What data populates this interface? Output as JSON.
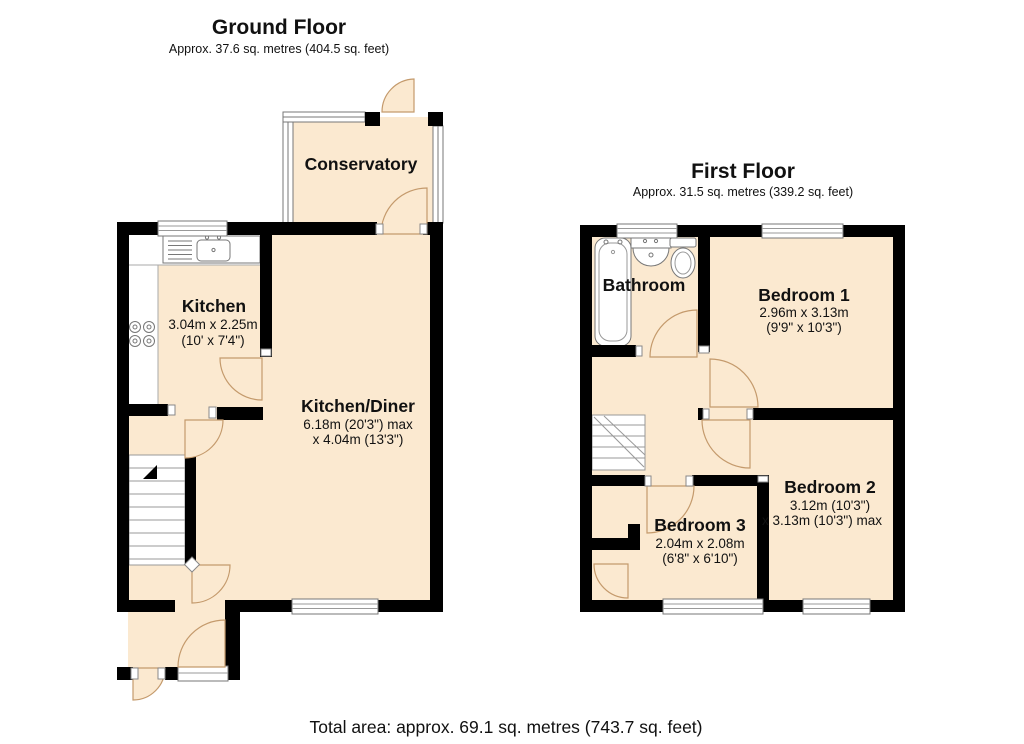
{
  "colors": {
    "room_fill": "#FBE9D0",
    "wall": "#000000",
    "door_arc_stroke": "#C49A6C",
    "fixture_stroke": "#777777"
  },
  "ground_floor": {
    "title": "Ground Floor",
    "subtitle": "Approx. 37.6 sq. metres (404.5 sq. feet)",
    "rooms": {
      "conservatory": {
        "name": "Conservatory"
      },
      "kitchen": {
        "name": "Kitchen",
        "dims_metric": "3.04m x 2.25m",
        "dims_imperial": "(10' x 7'4\")"
      },
      "kitchen_diner": {
        "name": "Kitchen/Diner",
        "dims_line1": "6.18m (20'3\") max",
        "dims_line2": "x 4.04m (13'3\")"
      }
    }
  },
  "first_floor": {
    "title": "First Floor",
    "subtitle": "Approx. 31.5 sq. metres (339.2 sq. feet)",
    "rooms": {
      "bathroom": {
        "name": "Bathroom"
      },
      "bedroom_1": {
        "name": "Bedroom 1",
        "dims_metric": "2.96m x 3.13m",
        "dims_imperial": "(9'9\" x 10'3\")"
      },
      "bedroom_2": {
        "name": "Bedroom 2",
        "dims_line1": "3.12m (10'3\")",
        "dims_line2": "x 3.13m (10'3\") max"
      },
      "bedroom_3": {
        "name": "Bedroom 3",
        "dims_metric": "2.04m x 2.08m",
        "dims_imperial": "(6'8\" x 6'10\")"
      }
    }
  },
  "footer": {
    "total_area": "Total area: approx. 69.1 sq. metres (743.7 sq. feet)"
  }
}
